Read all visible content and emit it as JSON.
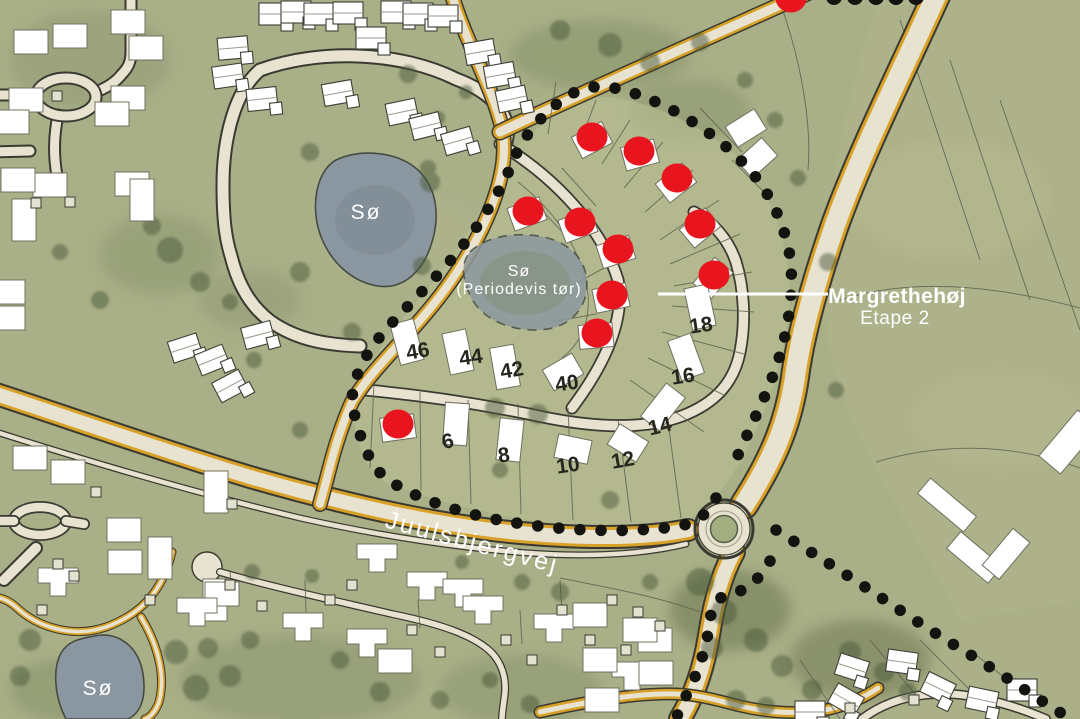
{
  "labels": {
    "development_title": "Margrethehøj",
    "development_stage": "Etape 2",
    "street": "Juulsbjergvej",
    "lake_top": "Sø",
    "lake_seasonal_line1": "Sø",
    "lake_seasonal_line2": "(Periodevis tør)",
    "lake_bottom": "Sø"
  },
  "plots": {
    "numbers": [
      {
        "label": "46",
        "x": 418,
        "y": 352,
        "rot": -10
      },
      {
        "label": "44",
        "x": 471,
        "y": 358,
        "rot": -8
      },
      {
        "label": "42",
        "x": 512,
        "y": 371,
        "rot": -10
      },
      {
        "label": "40",
        "x": 567,
        "y": 384,
        "rot": -8
      },
      {
        "label": "18",
        "x": 701,
        "y": 326,
        "rot": -8
      },
      {
        "label": "16",
        "x": 683,
        "y": 377,
        "rot": -8
      },
      {
        "label": "14",
        "x": 660,
        "y": 427,
        "rot": -14
      },
      {
        "label": "12",
        "x": 623,
        "y": 461,
        "rot": -10
      },
      {
        "label": "10",
        "x": 568,
        "y": 466,
        "rot": -8
      },
      {
        "label": "8",
        "x": 504,
        "y": 456,
        "rot": -8
      },
      {
        "label": "6",
        "x": 448,
        "y": 442,
        "rot": -12
      }
    ]
  },
  "markers": {
    "sold": [
      {
        "x": 592,
        "y": 137
      },
      {
        "x": 639,
        "y": 151
      },
      {
        "x": 677,
        "y": 178
      },
      {
        "x": 528,
        "y": 211
      },
      {
        "x": 580,
        "y": 222
      },
      {
        "x": 700,
        "y": 224
      },
      {
        "x": 618,
        "y": 249
      },
      {
        "x": 714,
        "y": 275
      },
      {
        "x": 612,
        "y": 295
      },
      {
        "x": 597,
        "y": 333
      },
      {
        "x": 398,
        "y": 424
      },
      {
        "x": 791,
        "y": -2
      }
    ]
  },
  "colors": {
    "bg": "#a9af87",
    "dev": "#b8bd92",
    "road": "#e8e2d0",
    "yellow": "#d8a127",
    "water": "#8b97a0",
    "boundary": "#131310",
    "red": "#e9151e",
    "label": "#ffffff",
    "number": "#26261f"
  }
}
